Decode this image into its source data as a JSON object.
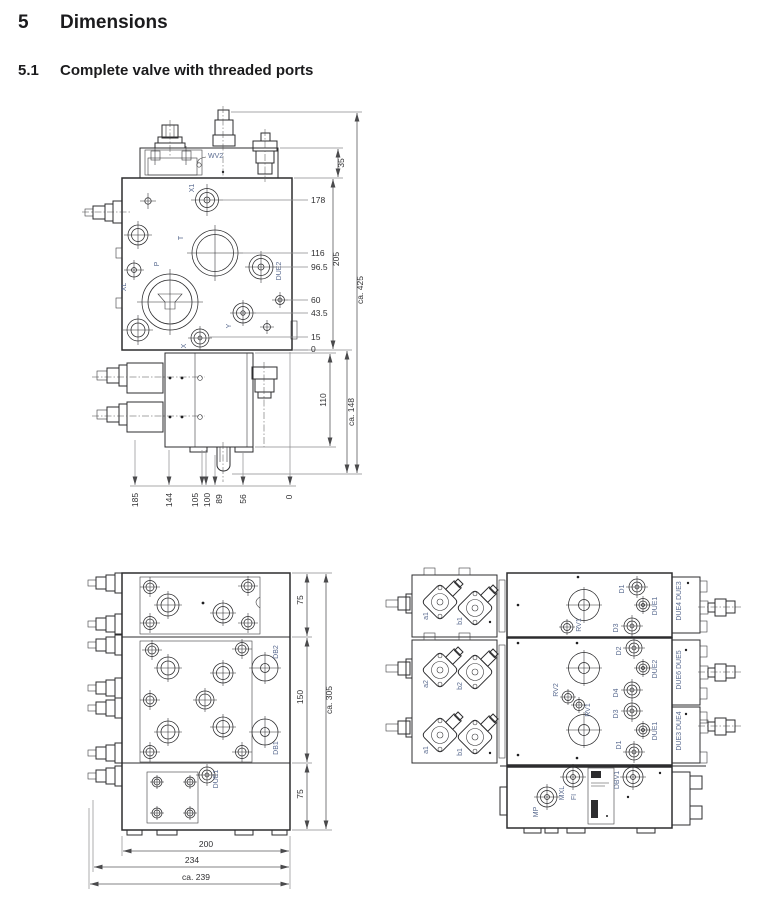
{
  "headings": {
    "section_number": "5",
    "section_title": "Dimensions",
    "subsection_number": "5.1",
    "subsection_title": "Complete valve with threaded ports"
  },
  "front_view": {
    "ports": {
      "wv2": "WV2",
      "x1": "X1",
      "t": "T",
      "p": "P",
      "xl": "XL",
      "due2": "DUE2",
      "y": "Y",
      "x": "X"
    },
    "dims_right": {
      "d35": "35",
      "d178": "178",
      "d116": "116",
      "d96_5": "96.5",
      "d205": "205",
      "d60": "60",
      "d43_5": "43.5",
      "d15": "15",
      "d0": "0",
      "total": "ca. 425",
      "d110": "110",
      "lower": "ca. 148"
    },
    "dims_bottom": [
      "185",
      "144",
      "105",
      "100",
      "89",
      "56",
      "0"
    ]
  },
  "top_view": {
    "ports": {
      "db2": "DB2",
      "db1": "DB1",
      "due1": "DUE1"
    },
    "dims_right": {
      "s1": "75",
      "s2": "150",
      "s3": "75",
      "total": "ca. 305"
    },
    "dims_bottom": [
      "200",
      "234",
      "ca. 239"
    ]
  },
  "side_view": {
    "section1": {
      "a1": "a1",
      "b1": "b1",
      "rv1": "RV1",
      "d1": "D1",
      "d3": "D3",
      "due1": "DUE1",
      "end_plate": "DUE4 DUE3"
    },
    "section2": {
      "a2": "a2",
      "b2": "b2",
      "a1": "a1",
      "b1": "b1",
      "rv2": "RV2",
      "rv1": "RV1",
      "d2": "D2",
      "due2": "DUE2",
      "d4": "D4",
      "d3": "D3",
      "due1": "DUE1",
      "d1": "D1",
      "end_plate_top": "DUE6 DUE5",
      "end_plate_bottom": "DUE3 DUE4"
    },
    "end_section": {
      "mp": "MP",
      "mxl": "MXL",
      "fi": "FI",
      "dbv1": "DBV1"
    }
  }
}
